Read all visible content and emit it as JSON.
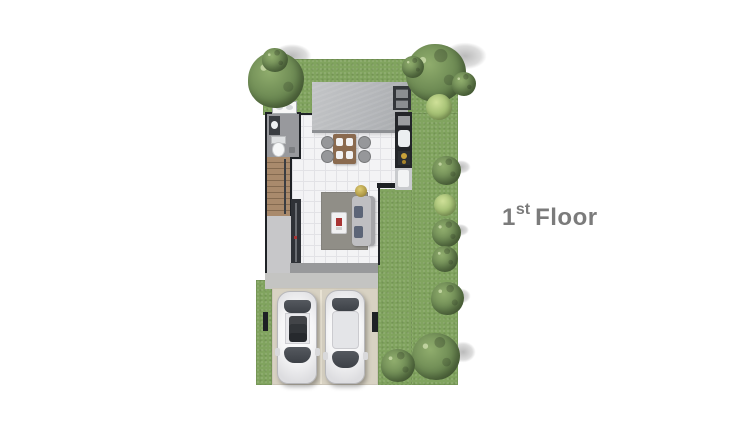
{
  "floor_label": {
    "number": "1",
    "suffix": "st",
    "word": "Floor"
  },
  "plan": {
    "type": "architectural-floor-plan",
    "view": "top-down",
    "rooms_visible": [
      "bathroom",
      "staircase",
      "kitchen",
      "dining-area",
      "living-room",
      "porch",
      "driveway"
    ],
    "site_features": [
      "lawn",
      "trees",
      "shrubs",
      "roof-slab",
      "air-conditioner-unit",
      "two-parked-cars"
    ]
  },
  "colors": {
    "lawn": "#81a45f",
    "tree": "#6b8852",
    "tree_dark": "#4d6739",
    "tree_light": "#90ad6d",
    "bush_light": "#a8c377",
    "roof": "#b5b7ba",
    "roof_edge": "#8d8f93",
    "wall": "#1e2125",
    "floor": "#f3f3f5",
    "tile": "#e2e2e6",
    "bath": "#98999d",
    "wood": "#a98a6c",
    "wood_dark": "#846a50",
    "concrete": "#c7c7c9",
    "concrete_dark": "#98999b",
    "driveway": "#d8d2c3",
    "drive_line": "#e9e3d4",
    "car": "#f6f6f7",
    "car_edge": "#b7b7ba",
    "glass": "#3d4147",
    "sunroof": "#26292d",
    "counter": "#232529",
    "steel": "#c9cbce",
    "amber": "#c9a23a",
    "rug": "#908e87",
    "sofa": "#bfbfc2",
    "cushion": "#5c6577",
    "table_wood": "#8a6a4f",
    "chair": "#96979a",
    "accent_red": "#a83434",
    "console": "#2f3237",
    "label": "#7b7b7b"
  }
}
